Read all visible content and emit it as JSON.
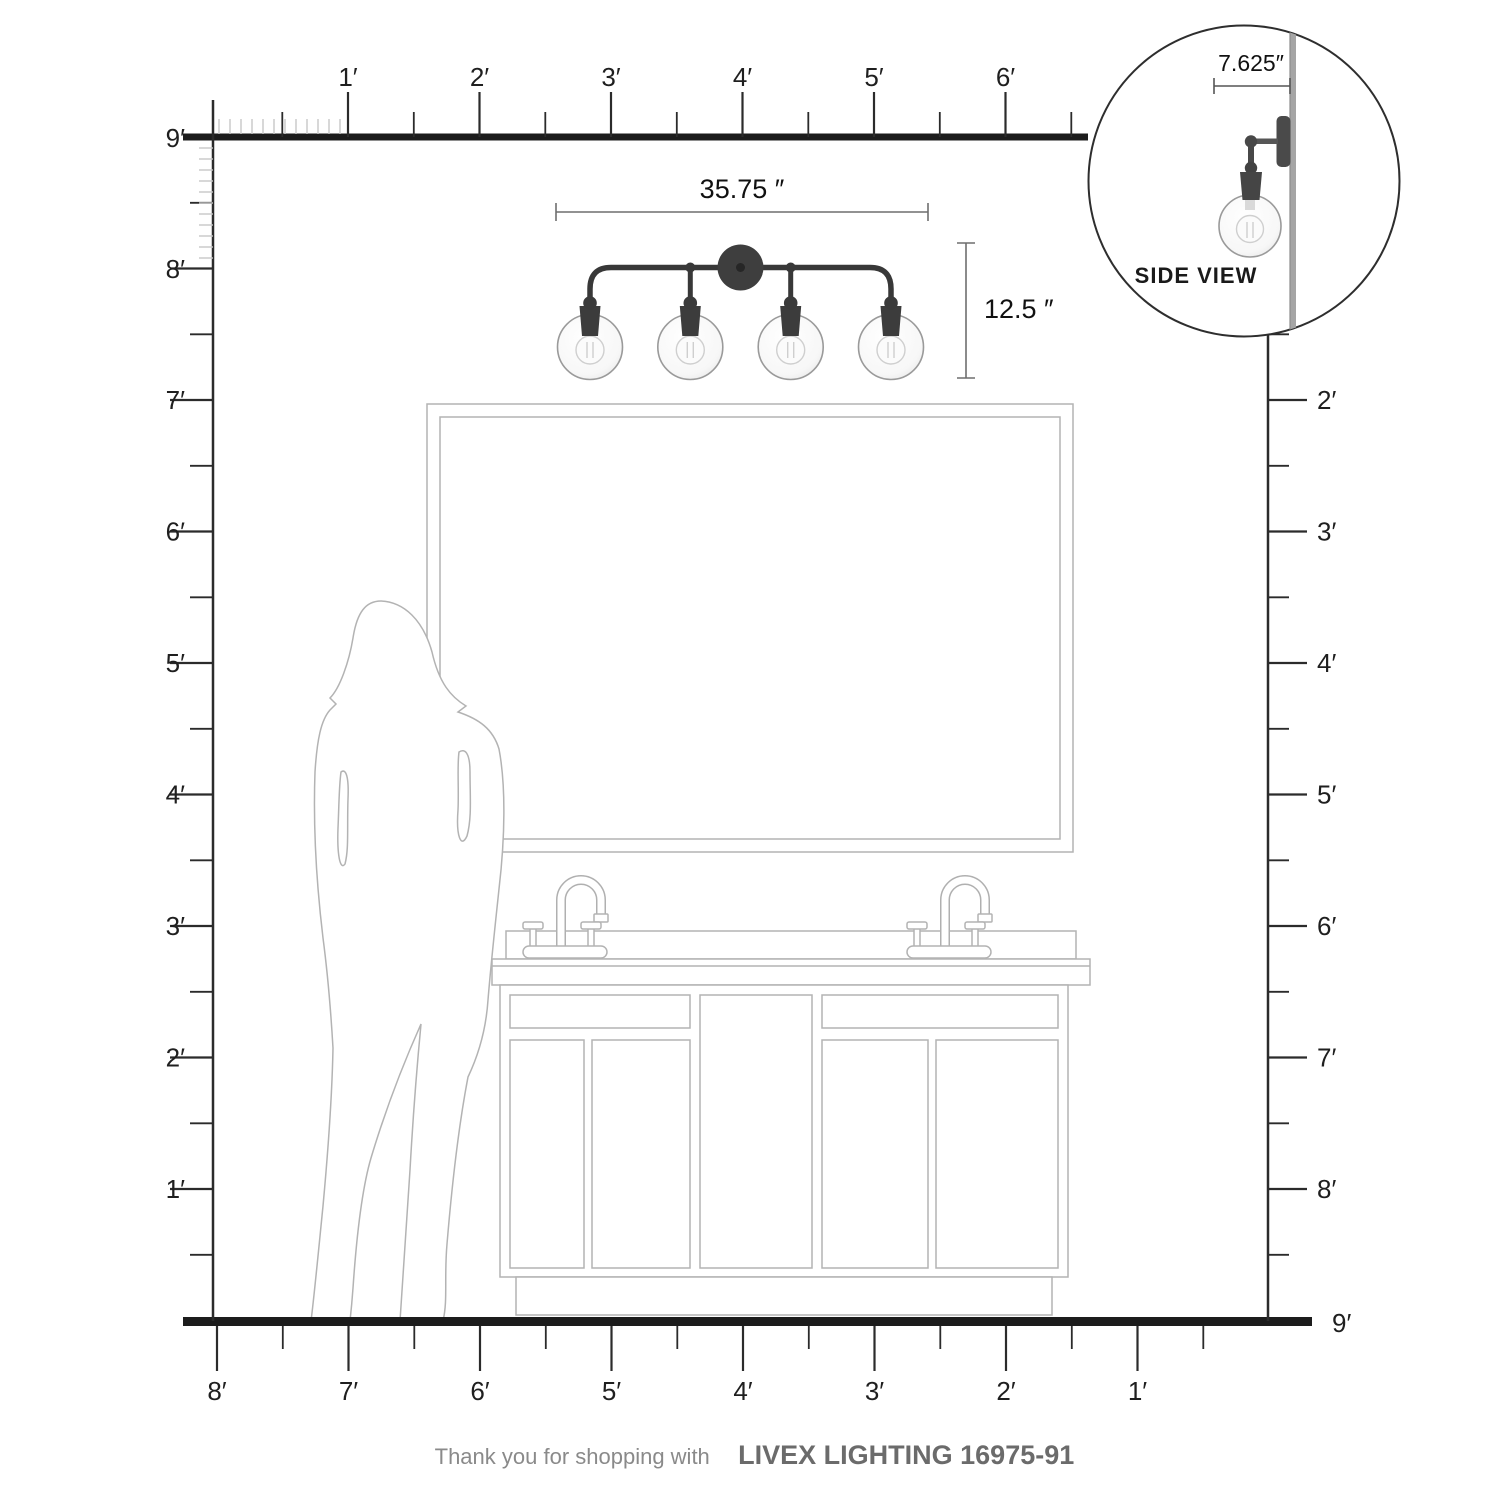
{
  "title": "Vanity light dimension diagram",
  "rulers": {
    "top": {
      "labels": [
        "1′",
        "2′",
        "3′",
        "4′",
        "5′",
        "6′"
      ]
    },
    "left": {
      "labels": [
        "9′",
        "8′",
        "7′",
        "6′",
        "5′",
        "4′",
        "3′",
        "2′",
        "1′"
      ]
    },
    "right": {
      "labels": [
        "2′",
        "3′",
        "4′",
        "5′",
        "6′",
        "7′",
        "8′"
      ],
      "floor_label": "9′"
    },
    "bottom": {
      "labels": [
        "8′",
        "7′",
        "6′",
        "5′",
        "4′",
        "3′",
        "2′",
        "1′"
      ]
    }
  },
  "fixture": {
    "width_label": "35.75 ″",
    "height_label": "12.5 ″",
    "num_lights": 4
  },
  "side_view": {
    "depth_label": "7.625″",
    "caption": "SIDE VIEW"
  },
  "footer": {
    "prefix": "Thank you for shopping with ",
    "brand": "LIVEX LIGHTING 16975-91"
  },
  "colors": {
    "ink": "#1c1c1c",
    "ruler": "#2b2b2b",
    "inch_tick": "#c8c8c8",
    "fixture_metal": "#3a3a3a",
    "drawing_line": "#b3b3b3",
    "wall_gray": "#a5a5a5",
    "footer_gray": "#8a8a8a",
    "footer_brand_gray": "#6b6b6b"
  }
}
